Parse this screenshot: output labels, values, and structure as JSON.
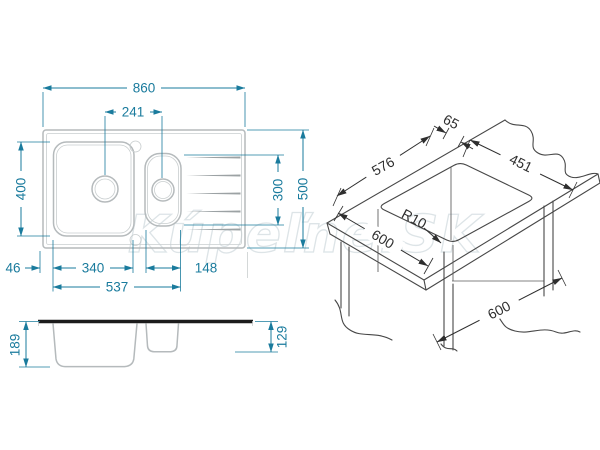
{
  "watermark": {
    "text": "Kúpeľne.SK"
  },
  "colors": {
    "dimension_teal": "#1a7b9d",
    "drawing_gray": "#b5babc",
    "iso_dark": "#474747",
    "rim_black": "#1c1c1c",
    "watermark_gray": "#dde4e7",
    "background": "#ffffff"
  },
  "views": {
    "top": {
      "dims": {
        "overall_width": "860",
        "drain_centers": "241",
        "bowl_length": "400",
        "overall_depth": "500",
        "right_section": "300",
        "left_offset": "46",
        "main_bowl_width": "340",
        "half_bowl_width": "148",
        "bowls_span": "537"
      }
    },
    "side": {
      "dims": {
        "main_bowl_depth": "189",
        "half_bowl_depth": "129"
      }
    },
    "install": {
      "dims": {
        "edge_offset": "65",
        "cutout_depth": "451",
        "cutout_width": "576",
        "corner_radius": "R10",
        "worktop_depth": "600",
        "cabinet_width": "600"
      }
    }
  }
}
